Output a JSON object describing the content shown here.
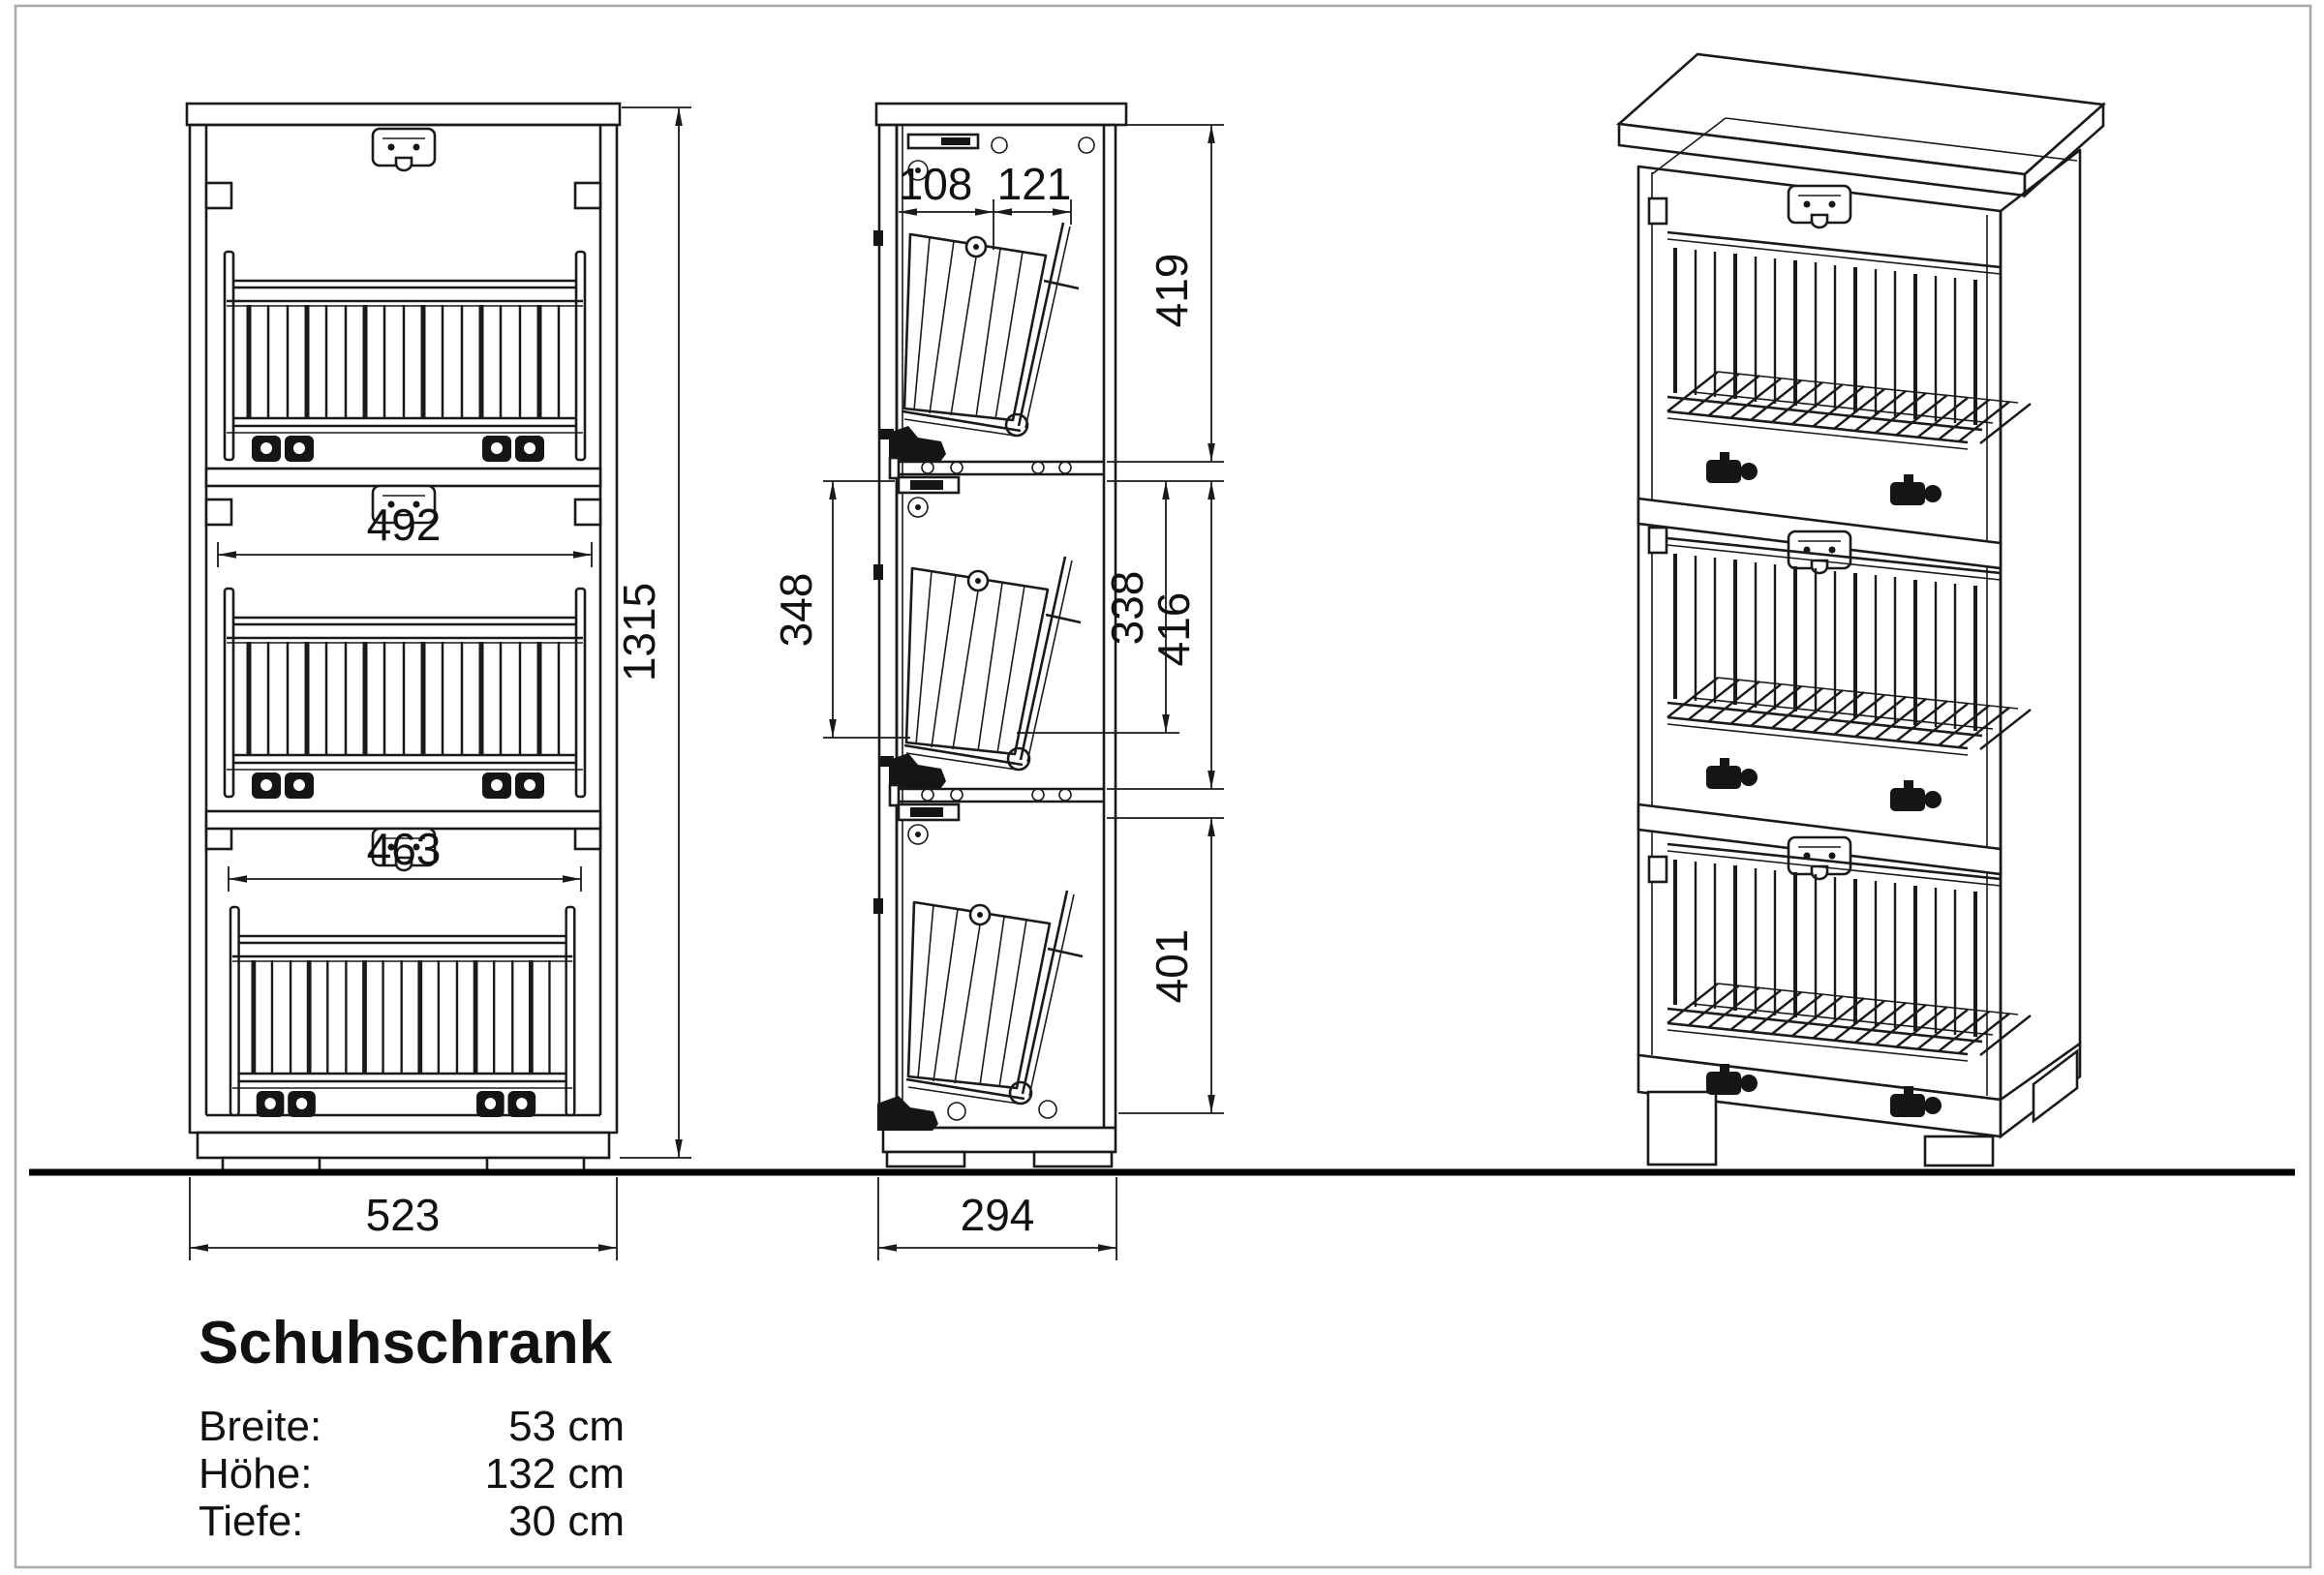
{
  "drawing": {
    "kind": "furniture technical drawing",
    "line_color": "#1a1a1a",
    "background": "#ffffff",
    "border_color": "#a8a8a8"
  },
  "dims": {
    "front_width": "523",
    "front_height": "1315",
    "front_basket_mid": "492",
    "front_basket_bottom": "463",
    "side_depth": "294",
    "side_top_left": "108",
    "side_top_right": "121",
    "side_sec1_height": "419",
    "side_sec2_height": "416",
    "side_basket2_height": "338",
    "side_basket2_left_height": "348",
    "side_sec3_height": "401"
  },
  "title_block": {
    "title": "Schuhschrank",
    "specs": [
      {
        "label": "Breite:",
        "value": "53 cm"
      },
      {
        "label": "Höhe:",
        "value": "132 cm"
      },
      {
        "label": "Tiefe:",
        "value": "30 cm"
      }
    ]
  }
}
